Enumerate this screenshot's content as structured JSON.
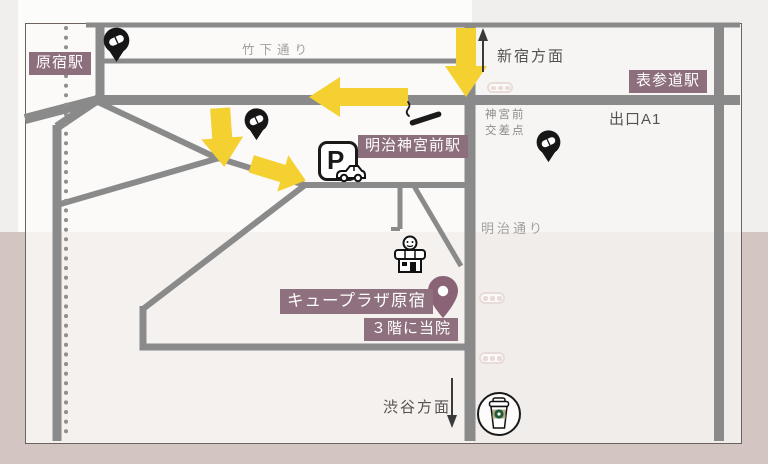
{
  "colors": {
    "accent_purple": "#8D6E7C",
    "destination_pin_purple": "#8B6377",
    "road_gray": "#8A8A8A",
    "arrow_yellow": "#F4D130",
    "background_bottom": "#D2C5C2",
    "background_top": "#F1EFEE",
    "crosswalk_pink": "#E9DBD7"
  },
  "map": {
    "stations": {
      "harajuku": "原宿駅",
      "omotesando": "表参道駅",
      "meiji_jingumae": "明治神宮前駅"
    },
    "streets": {
      "takeshita": "竹下通り",
      "meiji": "明治通り"
    },
    "directions": {
      "shinjuku": "新宿方面",
      "shibuya": "渋谷方面"
    },
    "intersection": {
      "line1": "神宮前",
      "line2": "交差点"
    },
    "exit_label": "出口A1",
    "destination": {
      "building": "キュープラザ原宿",
      "floor_note": "３階に当院"
    },
    "parking_letter": "P",
    "icon_names": [
      "pill-map-pin",
      "smoking-area-icon",
      "parking-icon",
      "storefront-icon",
      "destination-pin",
      "crosswalk-icon",
      "coffee-shop-icon",
      "railway-dotted-line"
    ]
  }
}
